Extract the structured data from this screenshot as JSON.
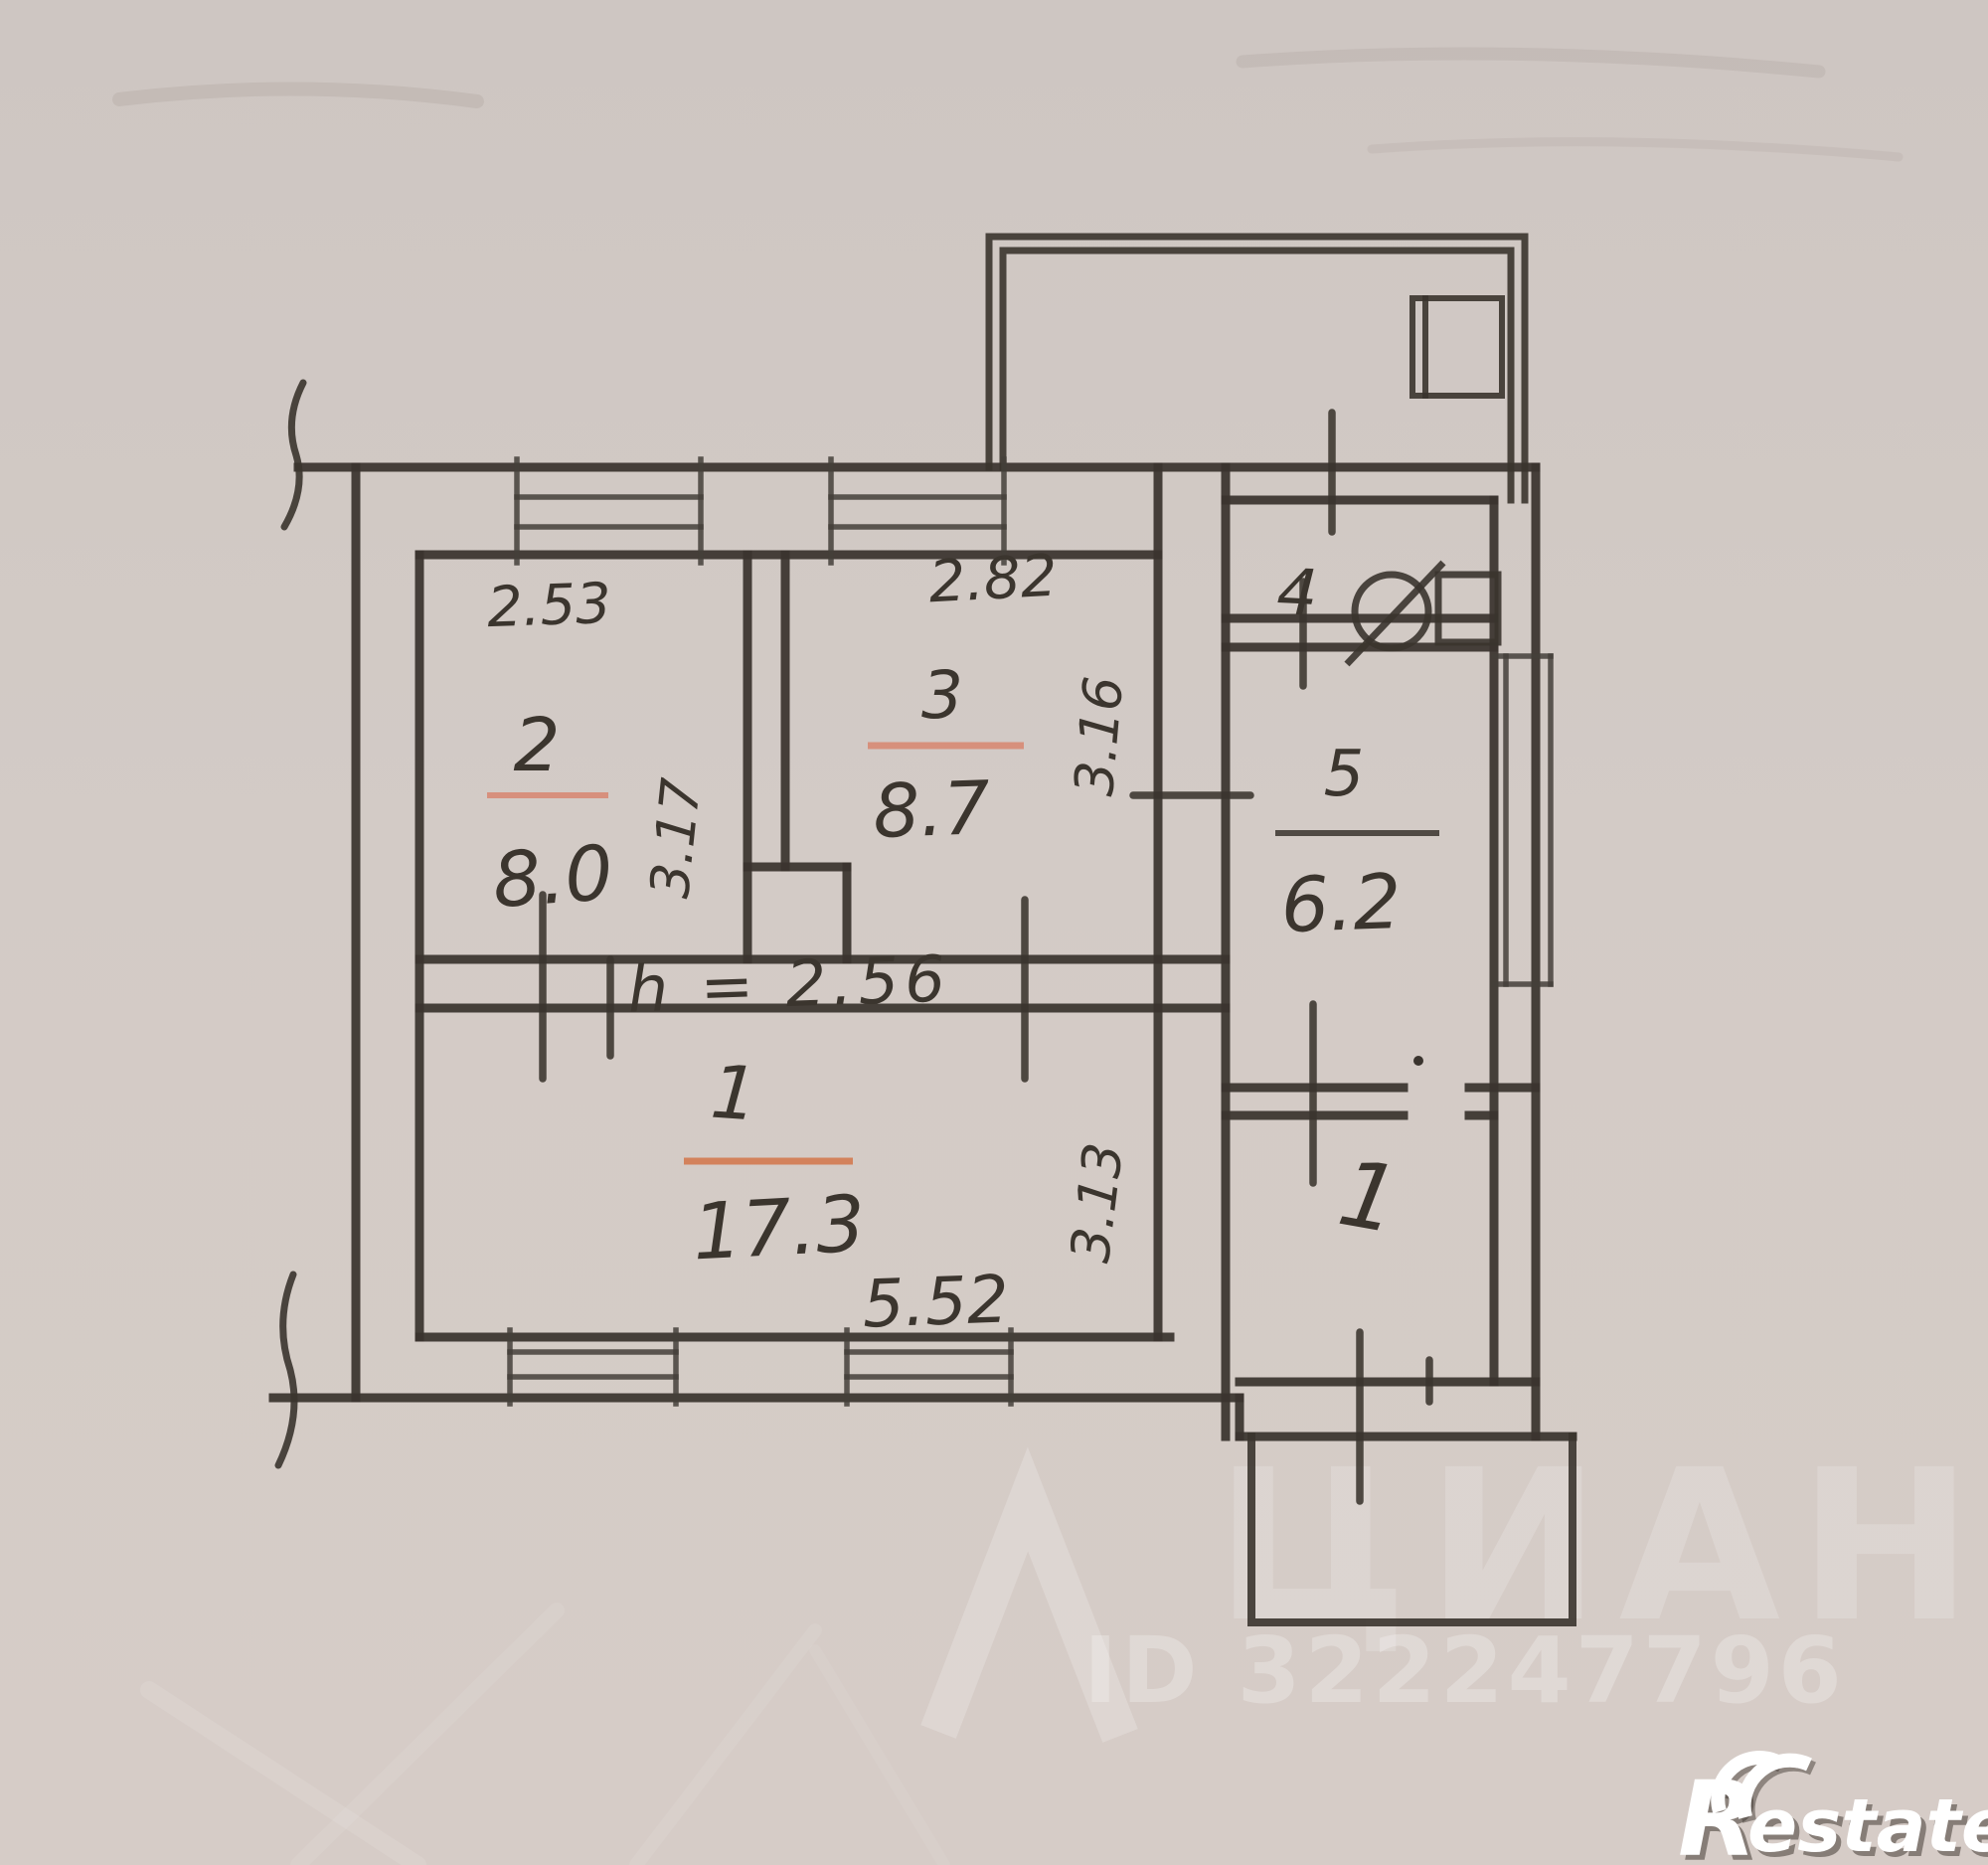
{
  "palette": {
    "paper": "#d1c9c4",
    "ink": "#3a342e",
    "accent_orange": "#c75b31",
    "accent_orange_soft": "#d9826b",
    "hall_orange": "#d3662d",
    "watermark_white": "#ffffff"
  },
  "rooms": {
    "living": {
      "number": "1",
      "area": "17.3",
      "width": "5.52",
      "depth": "3.13",
      "ceiling_height": "h = 2.56"
    },
    "bedroom": {
      "number": "2",
      "area": "8.0",
      "width": "2.53",
      "depth": "3.17"
    },
    "bedroom2": {
      "number": "3",
      "area": "8.7",
      "width": "2.82",
      "depth": "3.16"
    },
    "wc": {
      "number": "4"
    },
    "kitchen": {
      "number": "5",
      "area": "6.2"
    },
    "hall": {
      "number": "1"
    }
  },
  "watermarks": {
    "brand": "ЦИАН",
    "listing_id": "ID 322247796",
    "logo_initial": "R",
    "logo_rest": "estate"
  }
}
